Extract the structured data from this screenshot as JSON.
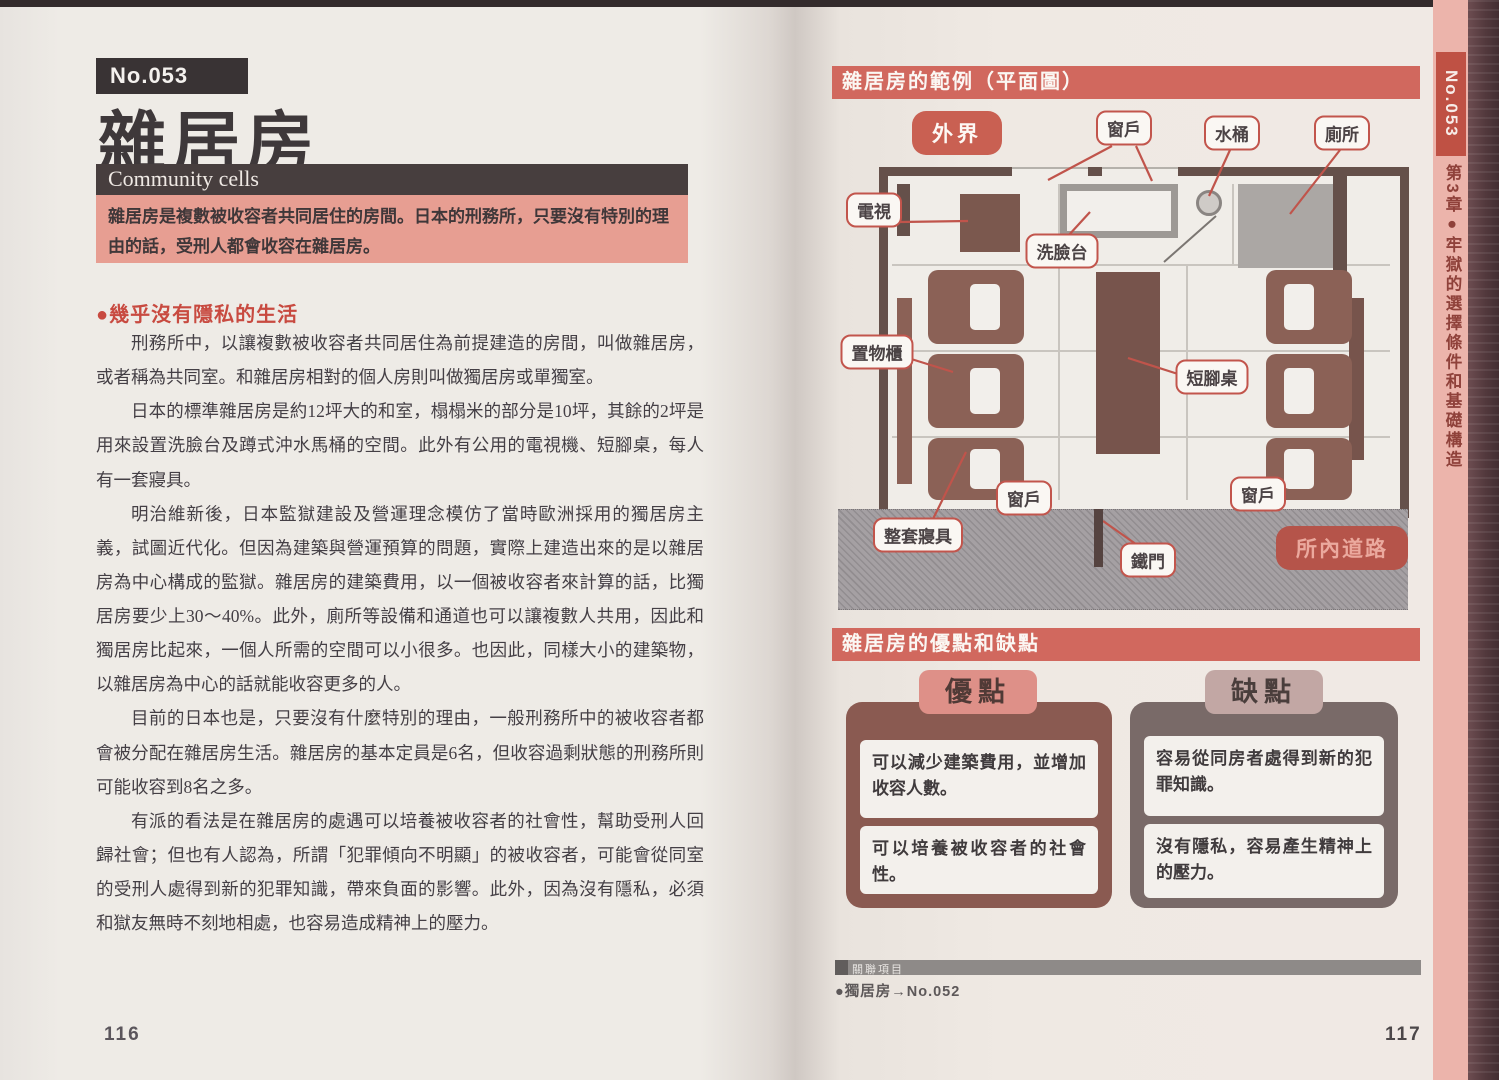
{
  "left_page": {
    "entry_number": "No.053",
    "title": "雜居房",
    "subtitle_en": "Community cells",
    "intro": "雜居房是複數被收容者共同居住的房間。日本的刑務所，只要沒有特別的理由的話，受刑人都會收容在雜居房。",
    "section_heading": "●幾乎沒有隱私的生活",
    "paragraphs": [
      "刑務所中，以讓複數被收容者共同居住為前提建造的房間，叫做雜居房，或者稱為共同室。和雜居房相對的個人房則叫做獨居房或單獨室。",
      "日本的標準雜居房是約12坪大的和室，榻榻米的部分是10坪，其餘的2坪是用來設置洗臉台及蹲式沖水馬桶的空間。此外有公用的電視機、短腳桌，每人有一套寢具。",
      "明治維新後，日本監獄建設及營運理念模仿了當時歐洲採用的獨居房主義，試圖近代化。但因為建築與營運預算的問題，實際上建造出來的是以雜居房為中心構成的監獄。雜居房的建築費用，以一個被收容者來計算的話，比獨居房要少上30～40%。此外，廁所等設備和通道也可以讓複數人共用，因此和獨居房比起來，一個人所需的空間可以小很多。也因此，同樣大小的建築物，以雜居房為中心的話就能收容更多的人。",
      "目前的日本也是，只要沒有什麼特別的理由，一般刑務所中的被收容者都會被分配在雜居房生活。雜居房的基本定員是6名，但收容過剩狀態的刑務所則可能收容到8名之多。",
      "有派的看法是在雜居房的處遇可以培養被收容者的社會性，幫助受刑人回歸社會；但也有人認為，所謂「犯罪傾向不明顯」的被收容者，可能會從同室的受刑人處得到新的犯罪知識，帶來負面的影響。此外，因為沒有隱私，必須和獄友無時不刻地相處，也容易造成精神上的壓力。"
    ],
    "page_number": "116"
  },
  "right_page": {
    "plan": {
      "title": "雜居房的範例（平面圖）",
      "labels": {
        "outside": "外界",
        "window_top": "窗戶",
        "bucket": "水桶",
        "toilet": "廁所",
        "tv": "電視",
        "sink": "洗臉台",
        "locker": "置物櫃",
        "low_table": "短腳桌",
        "window_bottom_left": "窗戶",
        "bedding": "整套寢具",
        "iron_door": "鐵門",
        "window_bottom_right": "窗戶",
        "road": "所內道路"
      }
    },
    "proscons": {
      "title": "雜居房的優點和缺點",
      "pros_label": "優點",
      "cons_label": "缺點",
      "pros": [
        "可以減少建築費用，並增加收容人數。",
        "可以培養被收容者的社會性。"
      ],
      "cons": [
        "容易從同房者處得到新的犯罪知識。",
        "沒有隱私，容易產生精神上的壓力。"
      ]
    },
    "footer": {
      "related_title": "關聯項目",
      "related_item": "●獨居房→No.052"
    },
    "page_number": "117"
  },
  "side_tab": {
    "entry_number": "No.053",
    "chapter": "第3章●牢獄的選擇條件和基礎構造"
  }
}
